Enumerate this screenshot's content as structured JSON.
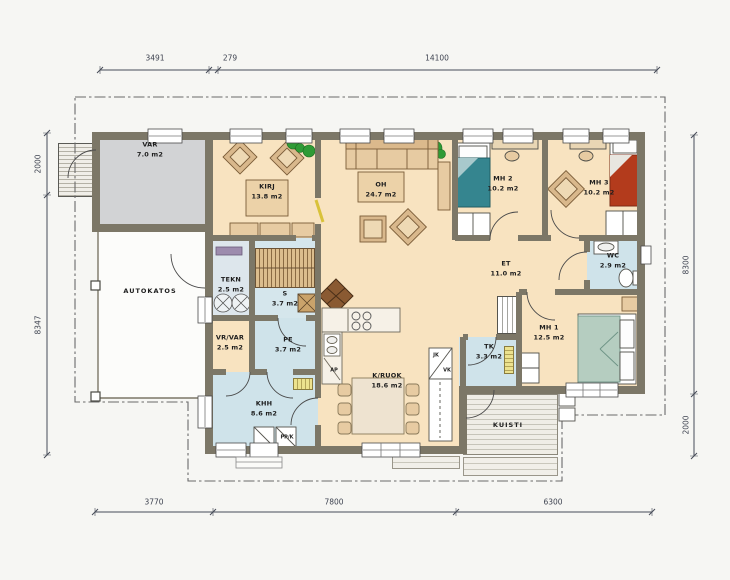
{
  "plan": {
    "rooms": [
      {
        "id": "var",
        "name": "VAR",
        "area": "7.0 m2"
      },
      {
        "id": "kirj",
        "name": "KIRJ",
        "area": "13.8 m2"
      },
      {
        "id": "oh",
        "name": "OH",
        "area": "24.7 m2"
      },
      {
        "id": "mh2",
        "name": "MH 2",
        "area": "10.2 m2"
      },
      {
        "id": "mh3",
        "name": "MH 3",
        "area": "10.2 m2"
      },
      {
        "id": "et",
        "name": "ET",
        "area": "11.0 m2"
      },
      {
        "id": "wc",
        "name": "WC",
        "area": "2.9 m2"
      },
      {
        "id": "mh1",
        "name": "MH 1",
        "area": "12.5 m2"
      },
      {
        "id": "tekn",
        "name": "TEKN",
        "area": "2.5 m2"
      },
      {
        "id": "s",
        "name": "S",
        "area": "3.7 m2"
      },
      {
        "id": "vrvar",
        "name": "VR/VAR",
        "area": "2.5 m2"
      },
      {
        "id": "pe",
        "name": "PE",
        "area": "3.7 m2"
      },
      {
        "id": "khh",
        "name": "KHH",
        "area": "8.6 m2"
      },
      {
        "id": "kruok",
        "name": "K/RUOK",
        "area": "18.6 m2"
      },
      {
        "id": "tk",
        "name": "TK",
        "area": "3.3 m2"
      },
      {
        "id": "kuisti",
        "name": "KUISTI",
        "area": ""
      },
      {
        "id": "autokatos",
        "name": "AUTOKATOS",
        "area": ""
      }
    ],
    "appliance_labels": {
      "fridge": "JK",
      "cold_cabinet": "VK",
      "dishwasher": "AP",
      "washer": "PP/K"
    },
    "dimensions": {
      "top": [
        "3491",
        "279",
        "14100"
      ],
      "bottom": [
        "3770",
        "7800",
        "6300"
      ],
      "left": [
        "2000",
        "8347"
      ],
      "right": [
        "8300",
        "2000"
      ]
    },
    "colors": {
      "wall": "#7c7767",
      "floor": "#f8e3c0",
      "wet_floor": "#cfe3ea",
      "storage_floor": "#d2d3d5",
      "bed_teal": "#35858f",
      "bed_red": "#b33b1c",
      "deck": "#efede6",
      "plant": "#2f9b36"
    }
  }
}
